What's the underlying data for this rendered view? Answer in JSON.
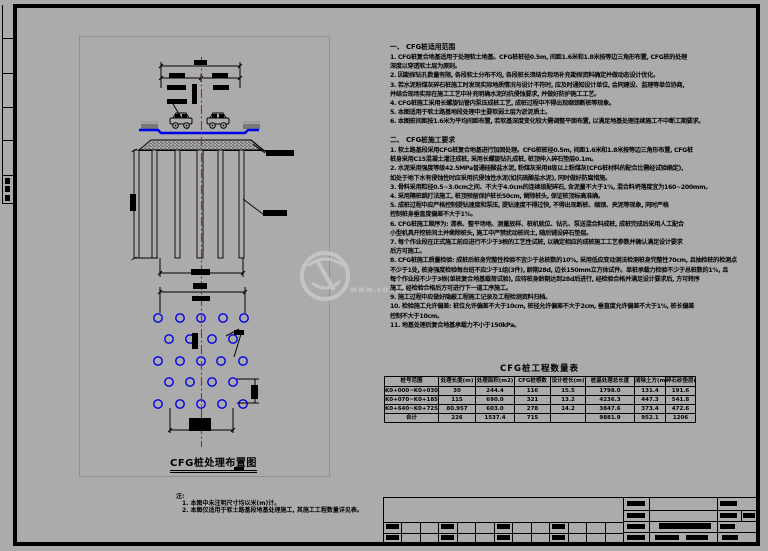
{
  "colors": {
    "background": "#ababab",
    "line": "#000000",
    "pile_circle_blue": "#0000e6",
    "road_surface_blue": "#0000e6",
    "centerline_red": "#ff0000",
    "viewport_border_gray": "#909090",
    "watermark_gray": "#c4c4c4"
  },
  "watermark": {
    "text": "www.co188.com"
  },
  "plan": {
    "caption": "CFG桩处理布置图"
  },
  "notes": {
    "title": "注:",
    "items": [
      "1. 本图中未注明尺寸均以米(m)计。",
      "2. 本图仅适用于软土路基段地基处理施工, 其施工工程数量详见表。"
    ]
  },
  "specs": [
    {
      "heading": "一、 CFG桩适用范围",
      "lines": [
        "1. CFG桩复合地基适用于处理软土地基。CFG桩桩径0.5m, 间距1.6米和1.8米按等边三角形布置, CFG桩的处理",
        "深度以穿透软土层为原则。",
        "2. 因勘探钻孔数量有限, 各段软土分布不均, 各段桩长须结合现场补充勘探资料确定并做动态设计优化。",
        "3. 若水泥粉煤灰碎石桩施工时发现实际地质情况与设计不符时, 应及时通知设计单位, 会同建设、监理等单位协商,",
        "并结合现场实际在施工工艺中补充明确水泥的抗侵蚀要求, 并做好防护施工工艺。",
        "4. CFG桩施工采用长螺旋钻管内泵压成桩工艺, 成桩过程中不得出现缩颈断桩等现象。",
        "5. 本图适用于软土路基地段处理中主要软弱土层为淤泥质土。",
        "6. 本图桩间距按1.6米为平均间距布置, 若软基深度变化较大需调整平面布置, 以满足地基处理连续施工不中断工期要求。"
      ]
    },
    {
      "heading": "二、 CFG桩施工要求",
      "lines": [
        "1. 软土路基段采用CFG桩复合地基进行加固处理。CFG桩桩径0.5m, 间距1.6米和1.8米按等边三角形布置, CFG桩",
        "桩身采用C15混凝土灌注成桩, 采用长螺旋钻孔成桩, 桩顶伸入碎石垫层0.1m。",
        "2. 水泥采用强度等级42.5MPa普通硅酸盐水泥, 粉煤灰采用Ⅱ级以上粉煤灰(CFG桩材料的配合比需经试验确定),",
        "如处于地下水有侵蚀性时应采用抗侵蚀性水泥(如抗硫酸盐水泥), 同时做好防腐措施。",
        "3. 骨料采用粒径0.5~3.0cm之间、不大于4.0cm的连续级配碎石, 含泥量不大于1%, 混合料坍落度宜为160~200mm。",
        "4. 采用隔桩跳打法施工, 桩顶预留保护桩长50cm, 凿除桩头, 保证桩顶标高准确。",
        "5. 成桩过程中应严格控制提钻速度和泵压, 提钻速度不得过快, 不得出现断桩、缩颈、夹泥等现象, 同时严格",
        "控制桩身垂直度偏差不大于1%。",
        "6. CFG桩施工顺序为: 清表、整平场地、测量放样、桩机就位、钻孔、泵送混合料成桩, 成桩完成后采用人工配合",
        "小型机具开挖桩间土并凿除桩头, 施工中严禁扰动桩间土, 随后铺设碎石垫层。",
        "7. 每个作业段在正式施工前应进行不少于3根的工艺性试桩, 以确定相应的成桩施工工艺参数并确认满足设计要求",
        "后方可施工。",
        "8. CFG桩施工质量检验: 成桩后桩身完整性检验不宜少于总桩数的10%, 采用低应变动测法检测桩身完整性70cm, 且抽检桩的检测点",
        "不少于1处, 桩身强度检验每台班不应少于1组(3件), 龄期28d, 边长150mm立方体试件。单桩承载力检验不少于总桩数的1%, 且",
        "每个作业段不少于3根(单桩复合地基载荷试验), 应待桩身龄期达到28d后进行, 经检验合格并满足设计要求后, 方可转序",
        "施工, 经检验合格后方可进行下一道工序施工。",
        "9. 施工过程中应做好隐蔽工程施工记录及工程检测资料归档。",
        "10. 检验施工允许偏差: 桩位允许偏差不大于10cm, 桩径允许偏差不大于2cm, 垂直度允许偏差不大于1%, 桩长偏差",
        "控制不大于10cm。",
        "11. 地基处理后复合地基承载力不小于150kPa。"
      ]
    }
  ],
  "table": {
    "title": "CFG桩工程数量表",
    "headers": [
      "桩号范围",
      "处理长度(m)",
      "处理面积(m2)",
      "CFG桩根数",
      "设计桩长(m)",
      "桩基处理总长度",
      "清除土方(m3)",
      "碎石砂垫层(m3)"
    ],
    "rows": [
      [
        "K0+000~K0+030",
        "30",
        "244.4",
        "116",
        "15.5",
        "1798.0",
        "131.4",
        "191.6"
      ],
      [
        "K0+070~K0+185",
        "115",
        "690.0",
        "321",
        "13.2",
        "4236.3",
        "447.3",
        "541.8"
      ],
      [
        "K0+640~K0+725.957",
        "80.957",
        "603.0",
        "278",
        "14.2",
        "3847.6",
        "373.4",
        "472.6"
      ],
      [
        "合计",
        "226",
        "1537.4",
        "715",
        "",
        "9881.9",
        "952.1",
        "1206"
      ]
    ]
  }
}
